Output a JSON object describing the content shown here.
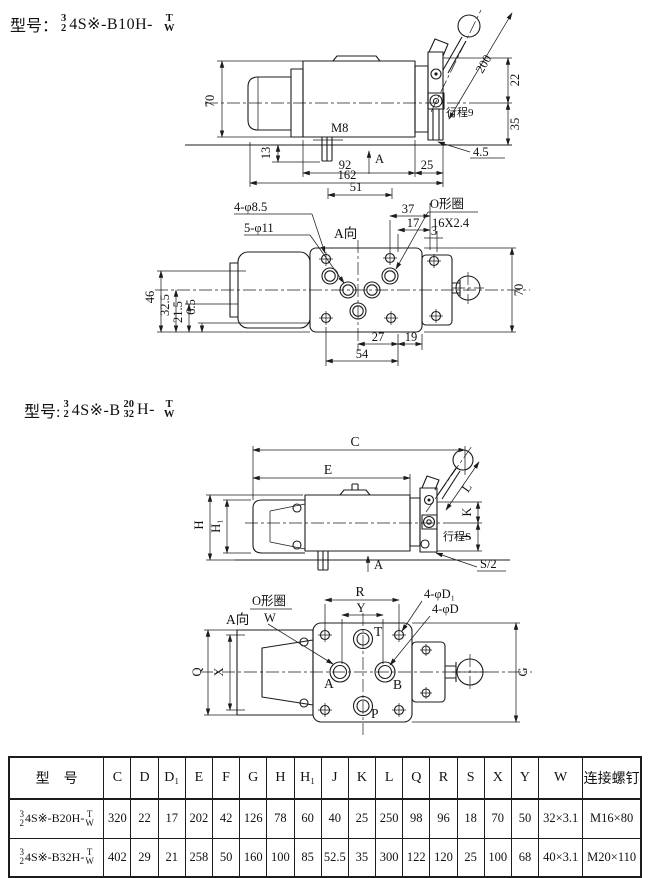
{
  "model1": {
    "prefix": "型号：",
    "num": "3",
    "den": "2",
    "body": "4S※-B10H-",
    "sup": "T",
    "sub": "W"
  },
  "model2": {
    "prefix": "型号:",
    "num": "3",
    "den": "2",
    "body": "4S※-B",
    "num2": "20",
    "den2": "32",
    "body2": "H-",
    "sup": "T",
    "sub": "W"
  },
  "fig1": {
    "side": {
      "height": "70",
      "thread": "M8",
      "stud_len": "13",
      "len_92": "92",
      "view_arrow": "A",
      "len_25": "25",
      "len_162": "162",
      "len_51": "51",
      "lever": "200",
      "off_22": "22",
      "off_35": "35",
      "stroke": "行程9",
      "gap": "4.5"
    },
    "bottom": {
      "mount_holes": "4-φ8.5",
      "port_holes": "5-φ11",
      "view": "A向",
      "len_37": "37",
      "len_17": "17",
      "len_3": "3",
      "oring": "O形圈",
      "oring_size": "16X2.4",
      "h_46": "46",
      "h_32_5": "32.5",
      "h_21_5": "21.5",
      "h_6_5": "6.5",
      "len_54": "54",
      "len_27": "27",
      "len_19": "19",
      "width_70": "70"
    }
  },
  "fig2": {
    "side": {
      "c": "C",
      "e": "E",
      "l": "L",
      "h": "H",
      "h1": "H₁",
      "k": "K",
      "j": "J",
      "stroke": "行程S",
      "s2": "S/2",
      "view_arrow": "A"
    },
    "bottom": {
      "view": "A向",
      "oring": "O形圈",
      "oring_w": "W",
      "r": "R",
      "y": "Y",
      "holes_d1": "4-φD₁",
      "holes_d": "4-φD",
      "t": "T",
      "a": "A",
      "b": "B",
      "p": "P",
      "q": "Q",
      "x": "X",
      "g": "G"
    }
  },
  "table": {
    "headers": [
      "型　号",
      "C",
      "D",
      "D₁",
      "E",
      "F",
      "G",
      "H",
      "H₁",
      "J",
      "K",
      "L",
      "Q",
      "R",
      "S",
      "X",
      "Y",
      "W",
      "连接螺钉"
    ],
    "rows": [
      {
        "model": {
          "num": "3",
          "den": "2",
          "body": "4S※-B20H-",
          "sup": "T",
          "sub": "W"
        },
        "cells": [
          "320",
          "22",
          "17",
          "202",
          "42",
          "126",
          "78",
          "60",
          "40",
          "25",
          "250",
          "98",
          "96",
          "18",
          "70",
          "50",
          "32×3.1",
          "M16×80"
        ]
      },
      {
        "model": {
          "num": "3",
          "den": "2",
          "body": "4S※-B32H-",
          "sup": "T",
          "sub": "W"
        },
        "cells": [
          "402",
          "29",
          "21",
          "258",
          "50",
          "160",
          "100",
          "85",
          "52.5",
          "35",
          "300",
          "122",
          "120",
          "25",
          "100",
          "68",
          "40×3.1",
          "M20×110"
        ]
      }
    ]
  }
}
